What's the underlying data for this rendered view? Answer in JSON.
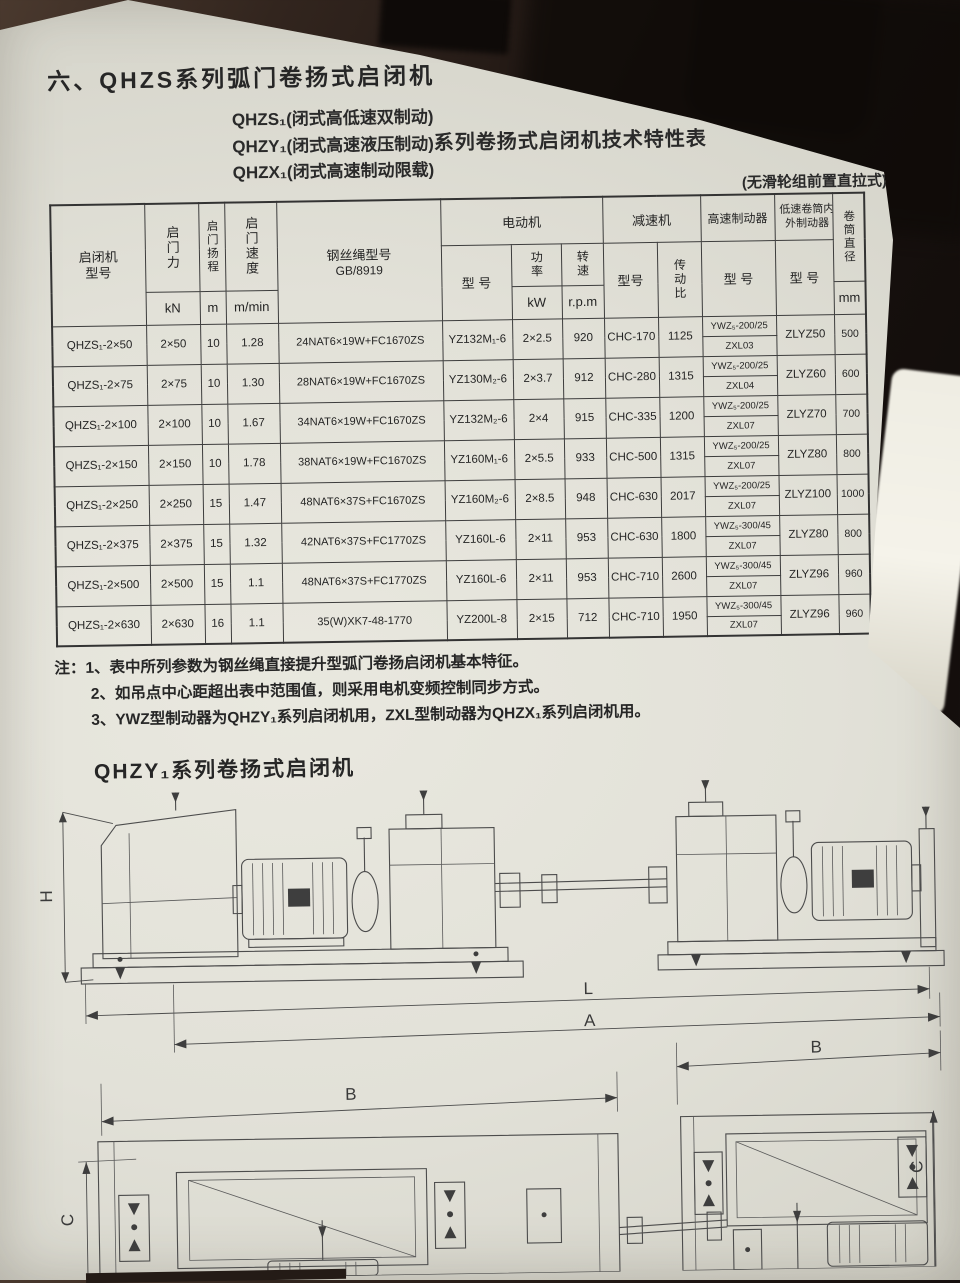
{
  "page": {
    "title": "六、QHZS系列弧门卷扬式启闭机",
    "subtitle": {
      "line1_model": "QHZS₁",
      "line1_desc": "(闭式高低速双制动)",
      "line2_model": "QHZY₁",
      "line2_desc": "(闭式高速液压制动)",
      "line2_suffix": "系列卷扬式启闭机技术特性表",
      "line3_model": "QHZX₁",
      "line3_desc": "(闭式高速制动限载)"
    },
    "table_note": "(无滑轮组前置直拉式)"
  },
  "table": {
    "headers": {
      "machine_model": "启闭机型号",
      "lifting_force": "启门力",
      "lifting_stroke": "启门扬程",
      "lifting_speed": "启门速度",
      "wire_rope": "钢丝绳型号",
      "wire_rope_std": "GB/8919",
      "motor_group": "电动机",
      "motor_model": "型 号",
      "motor_power": "功率",
      "motor_speed": "转速",
      "reducer_group": "减速机",
      "reducer_model": "型号",
      "reducer_ratio": "传动比",
      "hs_brake_group": "高速制动器",
      "hs_brake_model": "型 号",
      "ls_brake_group": "低速卷筒内外制动器",
      "ls_brake_model": "型 号",
      "drum_dia": "卷筒直径"
    },
    "units": {
      "force": "kN",
      "stroke": "m",
      "speed": "m/min",
      "power": "kW",
      "rpm": "r.p.m",
      "drum": "mm"
    },
    "rows": [
      {
        "model": "QHZS₁-2×50",
        "force": "2×50",
        "stroke": "10",
        "speed": "1.28",
        "rope": "24NAT6×19W+FC1670ZS",
        "motor": "YZ132M₁-6",
        "power": "2×2.5",
        "rpm": "920",
        "reducer": "CHC-170",
        "ratio": "1125",
        "hs_brake_ywz": "YWZ₅-200/25",
        "hs_brake_zxl": "ZXL03",
        "ls_brake": "ZLYZ50",
        "drum": "500"
      },
      {
        "model": "QHZS₁-2×75",
        "force": "2×75",
        "stroke": "10",
        "speed": "1.30",
        "rope": "28NAT6×19W+FC1670ZS",
        "motor": "YZ130M₂-6",
        "power": "2×3.7",
        "rpm": "912",
        "reducer": "CHC-280",
        "ratio": "1315",
        "hs_brake_ywz": "YWZ₅-200/25",
        "hs_brake_zxl": "ZXL04",
        "ls_brake": "ZLYZ60",
        "drum": "600"
      },
      {
        "model": "QHZS₁-2×100",
        "force": "2×100",
        "stroke": "10",
        "speed": "1.67",
        "rope": "34NAT6×19W+FC1670ZS",
        "motor": "YZ132M₂-6",
        "power": "2×4",
        "rpm": "915",
        "reducer": "CHC-335",
        "ratio": "1200",
        "hs_brake_ywz": "YWZ₅-200/25",
        "hs_brake_zxl": "ZXL07",
        "ls_brake": "ZLYZ70",
        "drum": "700"
      },
      {
        "model": "QHZS₁-2×150",
        "force": "2×150",
        "stroke": "10",
        "speed": "1.78",
        "rope": "38NAT6×19W+FC1670ZS",
        "motor": "YZ160M₁-6",
        "power": "2×5.5",
        "rpm": "933",
        "reducer": "CHC-500",
        "ratio": "1315",
        "hs_brake_ywz": "YWZ₅-200/25",
        "hs_brake_zxl": "ZXL07",
        "ls_brake": "ZLYZ80",
        "drum": "800"
      },
      {
        "model": "QHZS₁-2×250",
        "force": "2×250",
        "stroke": "15",
        "speed": "1.47",
        "rope": "48NAT6×37S+FC1670ZS",
        "motor": "YZ160M₂-6",
        "power": "2×8.5",
        "rpm": "948",
        "reducer": "CHC-630",
        "ratio": "2017",
        "hs_brake_ywz": "YWZ₅-200/25",
        "hs_brake_zxl": "ZXL07",
        "ls_brake": "ZLYZ100",
        "drum": "1000"
      },
      {
        "model": "QHZS₁-2×375",
        "force": "2×375",
        "stroke": "15",
        "speed": "1.32",
        "rope": "42NAT6×37S+FC1770ZS",
        "motor": "YZ160L-6",
        "power": "2×11",
        "rpm": "953",
        "reducer": "CHC-630",
        "ratio": "1800",
        "hs_brake_ywz": "YWZ₅-300/45",
        "hs_brake_zxl": "ZXL07",
        "ls_brake": "ZLYZ80",
        "drum": "800"
      },
      {
        "model": "QHZS₁-2×500",
        "force": "2×500",
        "stroke": "15",
        "speed": "1.1",
        "rope": "48NAT6×37S+FC1770ZS",
        "motor": "YZ160L-6",
        "power": "2×11",
        "rpm": "953",
        "reducer": "CHC-710",
        "ratio": "2600",
        "hs_brake_ywz": "YWZ₅-300/45",
        "hs_brake_zxl": "ZXL07",
        "ls_brake": "ZLYZ96",
        "drum": "960"
      },
      {
        "model": "QHZS₁-2×630",
        "force": "2×630",
        "stroke": "16",
        "speed": "1.1",
        "rope": "35(W)XK7-48-1770",
        "motor": "YZ200L-8",
        "power": "2×15",
        "rpm": "712",
        "reducer": "CHC-710",
        "ratio": "1950",
        "hs_brake_ywz": "YWZ₅-300/45",
        "hs_brake_zxl": "ZXL07",
        "ls_brake": "ZLYZ96",
        "drum": "960"
      }
    ]
  },
  "notes": {
    "label": "注：",
    "items": [
      "1、表中所列参数为钢丝绳直接提升型弧门卷扬启闭机基本特征。",
      "2、如吊点中心距超出表中范围值，则采用电机变频控制同步方式。",
      "3、YWZ型制动器为QHZY₁系列启闭机用，ZXL型制动器为QHZX₁系列启闭机用。"
    ]
  },
  "section2_title": "QHZY₁系列卷扬式启闭机",
  "diagram": {
    "labels": {
      "H": "H",
      "L": "L",
      "A": "A",
      "B_left": "B",
      "B_right": "B",
      "C_left": "C",
      "C_right": "C"
    }
  }
}
